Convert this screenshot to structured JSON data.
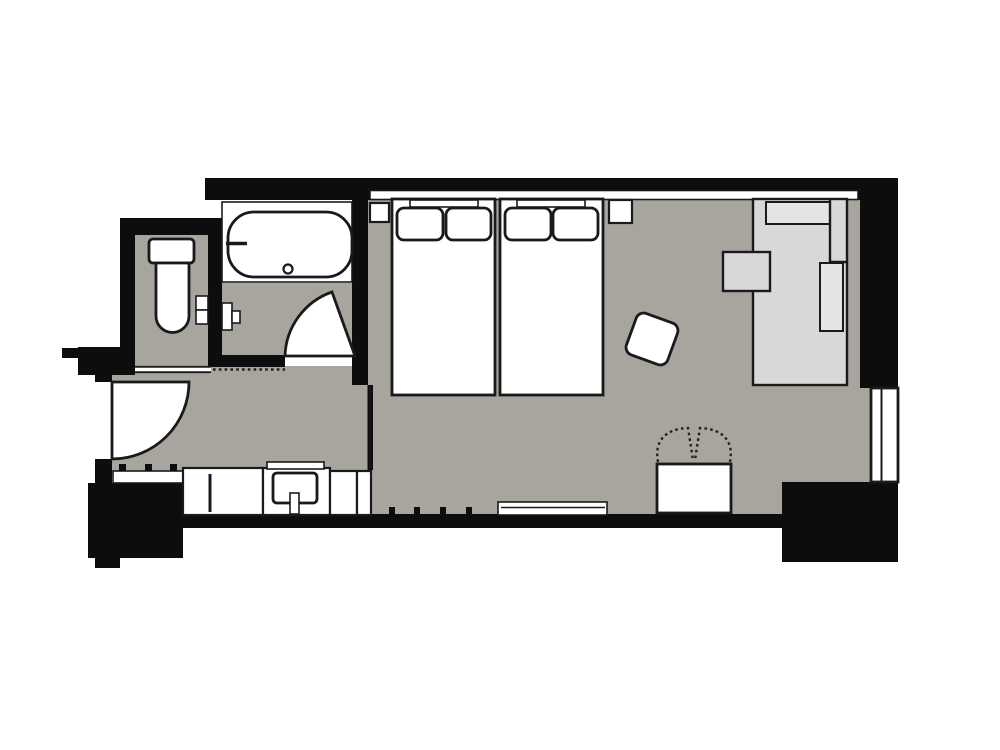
{
  "title": "Hotel guest room floor plan",
  "canvas": {
    "width": 1000,
    "height": 750
  },
  "colors": {
    "background": "#ffffff",
    "wall": "#0d0d0d",
    "floor": "#a8a49e",
    "fixture": "#ffffff",
    "outline": "#1a1a1a",
    "desk": "#d8d8d8",
    "desk_inner": "#e4e4e4",
    "dash": "#222222"
  },
  "rooms": [
    {
      "id": "toilet-room"
    },
    {
      "id": "bathroom"
    },
    {
      "id": "entrance-hall"
    },
    {
      "id": "vanity-corridor"
    },
    {
      "id": "bedroom"
    }
  ],
  "fixtures": {
    "beds": 2,
    "pillows_per_bed": 2,
    "nightstands": 2,
    "bathtub": 1,
    "toilet": 1,
    "washbasin": 1,
    "desk_counter": 1,
    "desk_chair": 1,
    "stool": 1,
    "luggage_rack": 1,
    "low_board": 1,
    "entrance_door": 1,
    "bathroom_door": 1,
    "toilet_sliding_door": 1,
    "window": 1
  }
}
